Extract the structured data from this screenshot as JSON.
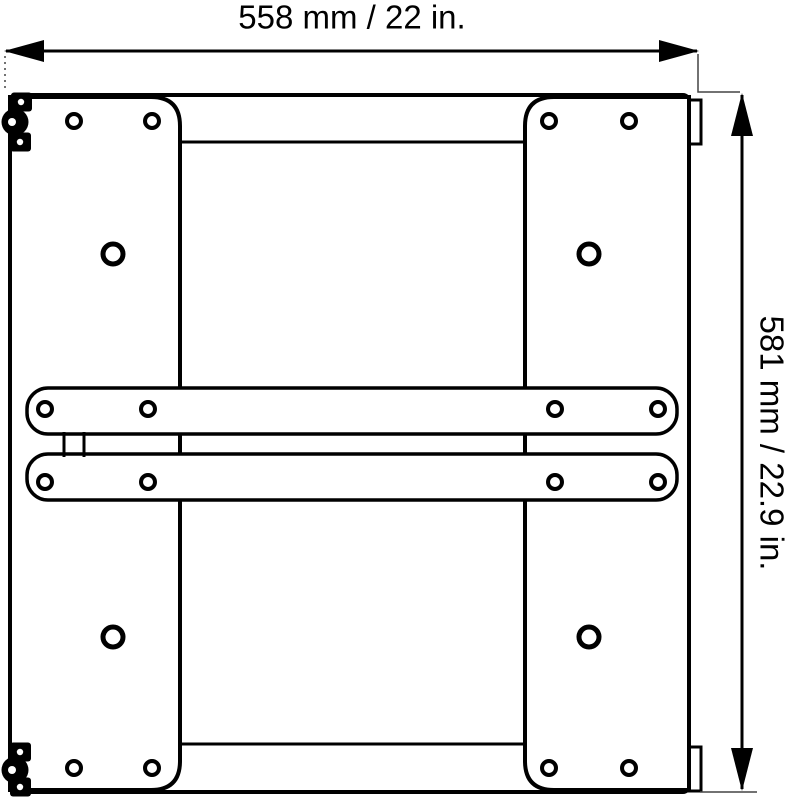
{
  "page": {
    "background": "#ffffff"
  },
  "diagram": {
    "name": "mounting-plate-dimensioned-drawing",
    "line_color": "#000000",
    "thin_line_color": "#444444",
    "fill_color": "#ffffff",
    "labels": {
      "width": "558 mm / 22 in.",
      "height": "581 mm / 22.9 in."
    },
    "holes": {
      "small": [
        [
          74,
          121
        ],
        [
          152,
          121
        ],
        [
          549,
          121
        ],
        [
          629,
          121
        ],
        [
          45,
          409
        ],
        [
          148,
          409
        ],
        [
          555,
          409
        ],
        [
          658,
          409
        ],
        [
          45,
          482
        ],
        [
          148,
          482
        ],
        [
          555,
          482
        ],
        [
          658,
          482
        ],
        [
          74,
          768
        ],
        [
          152,
          768
        ],
        [
          549,
          768
        ],
        [
          629,
          768
        ]
      ],
      "large": [
        [
          113,
          254
        ],
        [
          589,
          254
        ],
        [
          113,
          637
        ],
        [
          589,
          637
        ]
      ]
    },
    "latches": [
      {
        "squares": [
          [
            21,
            102
          ],
          [
            20,
            142
          ]
        ],
        "circle": [
          15,
          122
        ]
      },
      {
        "squares": [
          [
            20,
            752
          ],
          [
            20,
            787
          ]
        ],
        "circle": [
          15,
          770
        ]
      }
    ]
  }
}
